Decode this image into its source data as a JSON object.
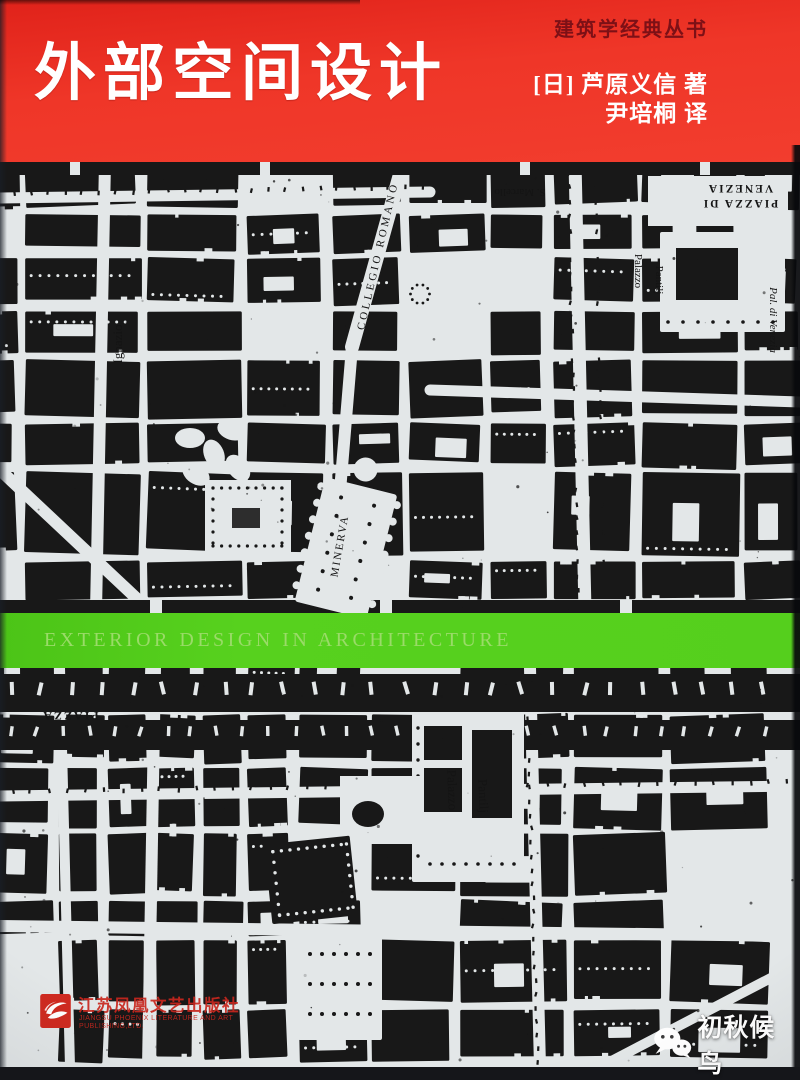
{
  "cover": {
    "series_title": "建筑学经典丛书",
    "title": "外部空间设计",
    "author_line": "[日] 芦原义信  著",
    "translator_line": "尹培桐  译",
    "subtitle_band": "EXTERIOR DESIGN IN ARCHITECTURE",
    "colors": {
      "cover_red": "#ee3126",
      "series_text": "#7d1016",
      "band_green": "#55cf1d",
      "band_text_green": "#9adb68",
      "map_paper": "#e3e7e8",
      "map_ink": "#181818",
      "publisher_red": "#c8271e"
    }
  },
  "maps": {
    "upper": {
      "labels": {
        "collegio_romano": "COLLEGIO ROMANO",
        "ignazio": "Ignazio",
        "minerva": "MINERVA",
        "piazza_di": "PIAZZA DI",
        "venezia": "VENEZIA",
        "s_marcello": "S. Marcello",
        "pal_di_venezia": "Pal. di Venezia",
        "palazzo": "Palazzo",
        "pantilj": "Pantilj"
      }
    },
    "lower": {
      "labels": {
        "palazzo": "Palazzo",
        "pantilj": "Pantilj",
        "piazza": "PIAZZA"
      }
    }
  },
  "publisher": {
    "logo": "phoenix-icon",
    "name_cn": "江苏凤凰文艺出版社",
    "name_en_line1": "JIANGSU PHOENIX LITERATURE AND ART",
    "name_en_line2": "PUBLISHING,LTD."
  },
  "watermark": {
    "icon": "wechat-icon",
    "text": "初秋候鸟"
  }
}
